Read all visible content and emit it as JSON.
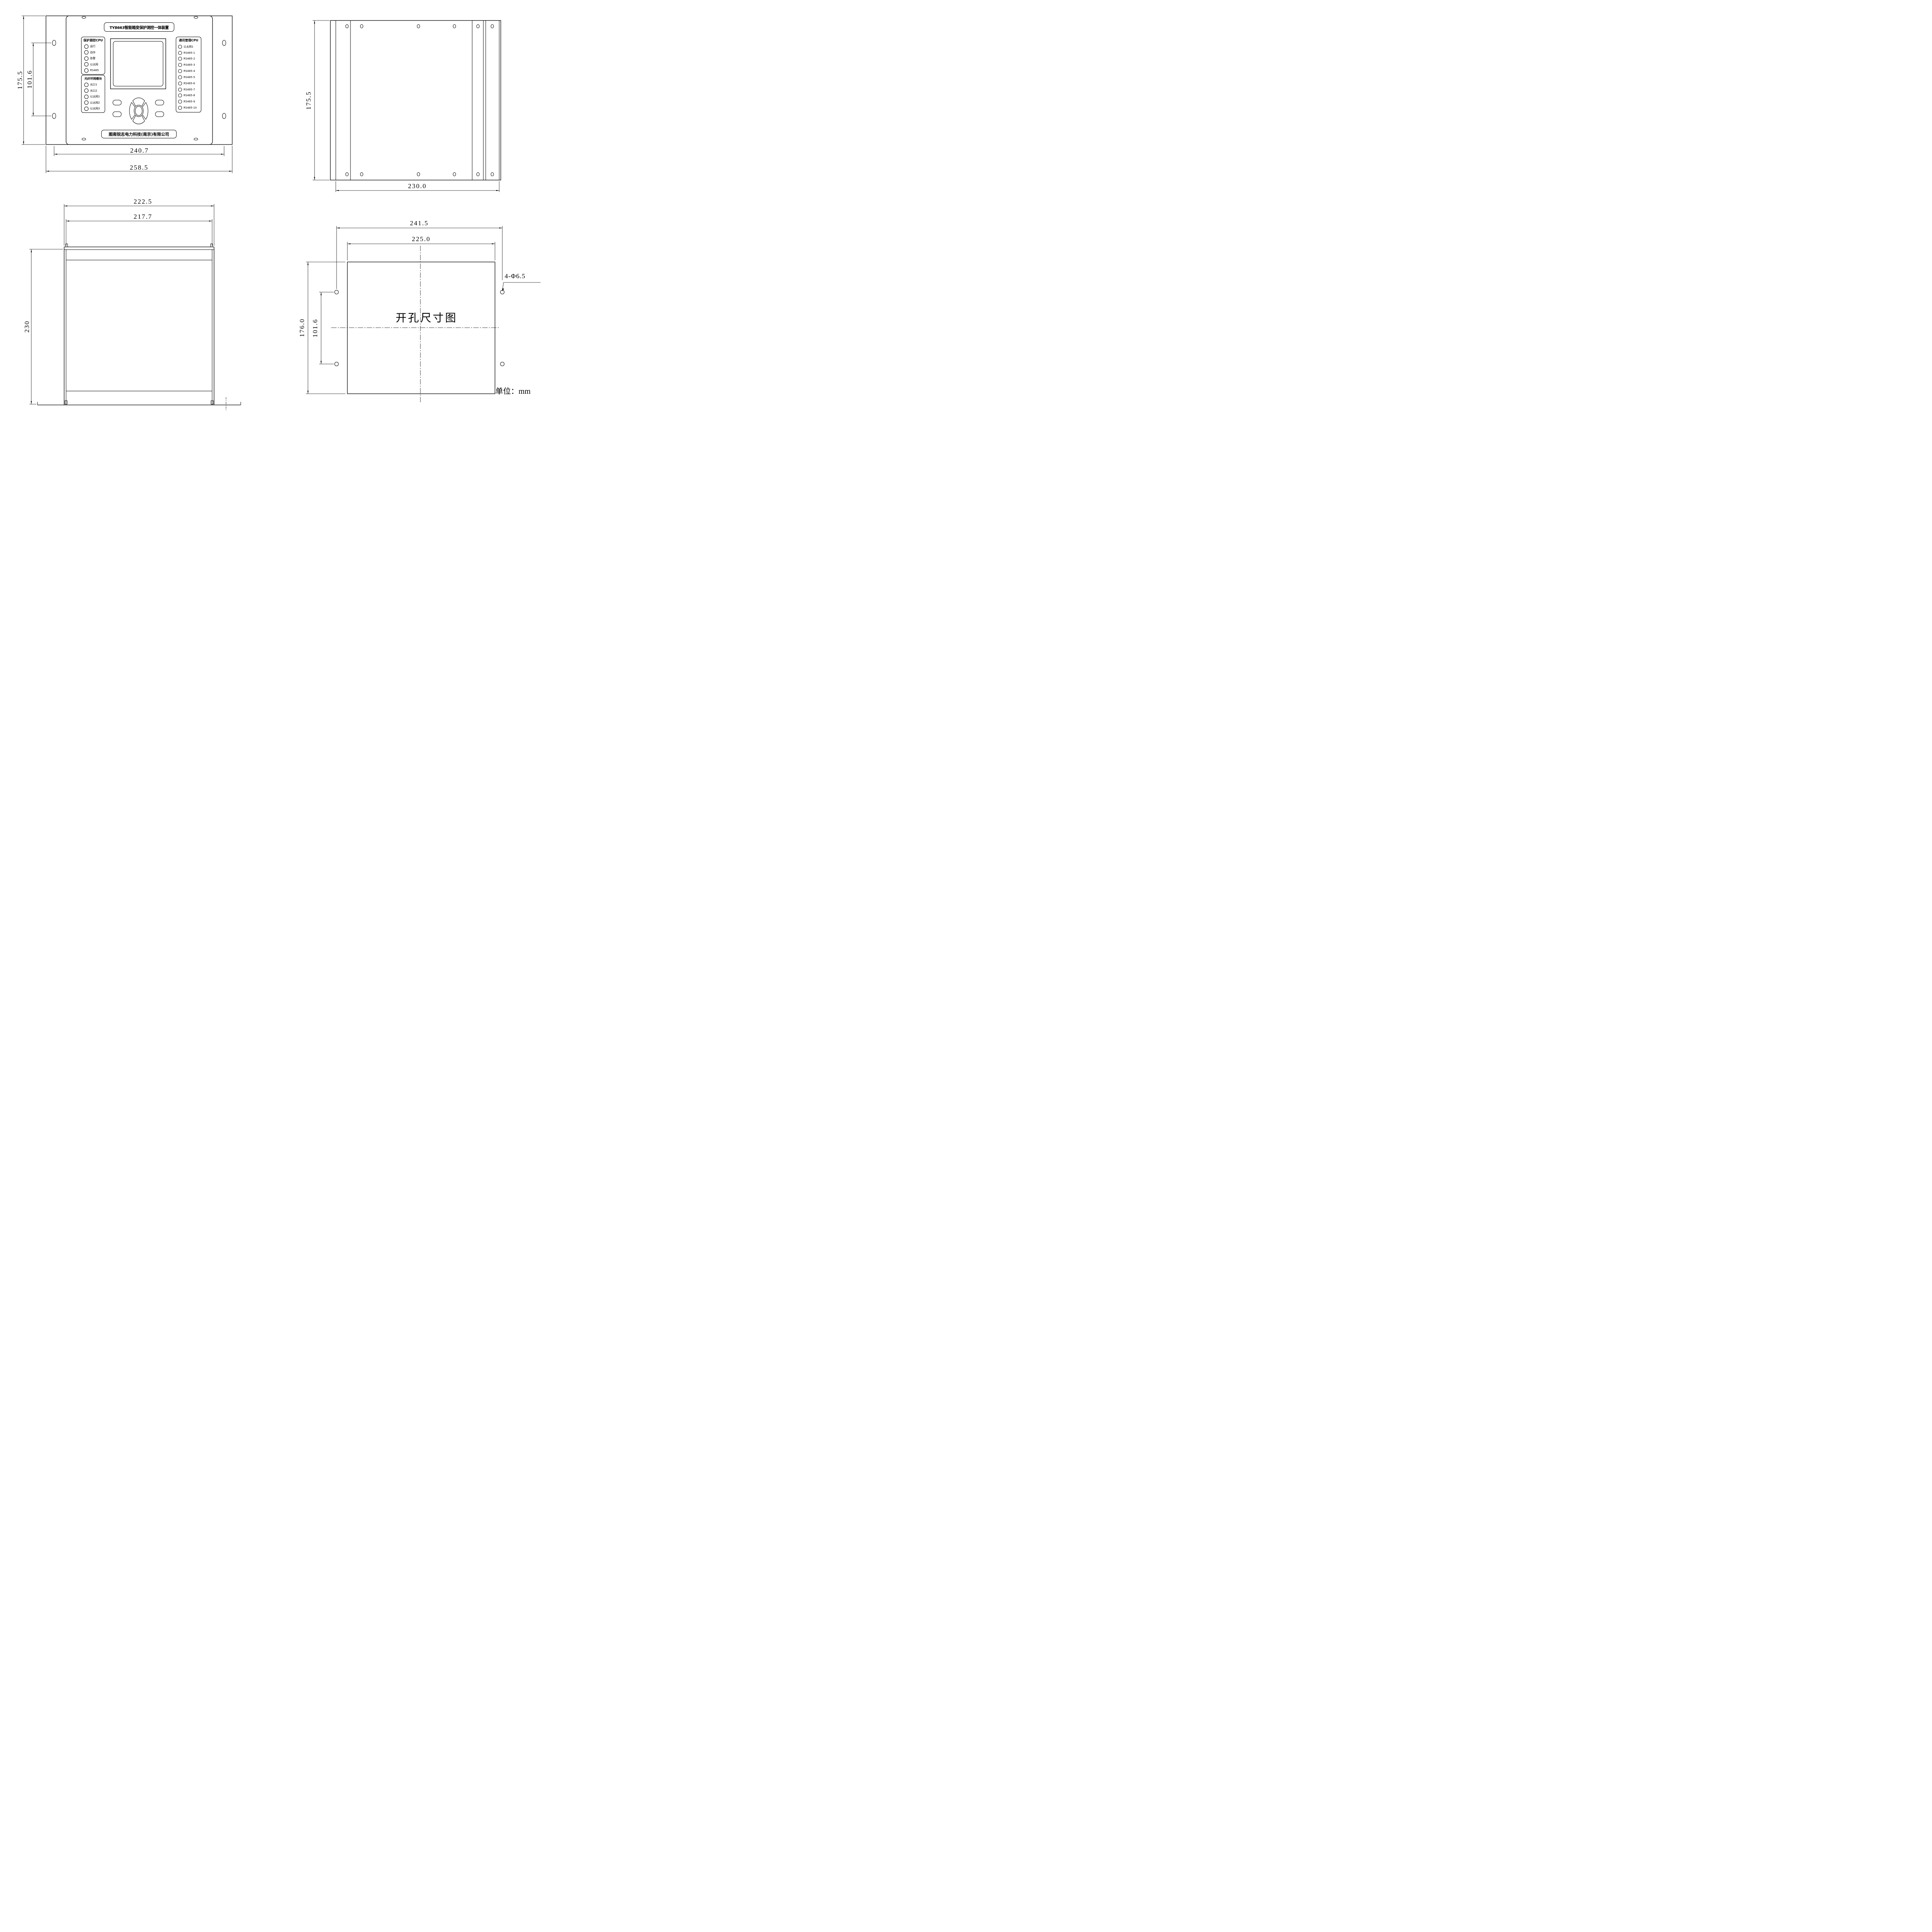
{
  "colors": {
    "ink": "#000000",
    "paper": "#ffffff"
  },
  "unit_note": "单位：mm",
  "front_view": {
    "title": "TY8663智能箱变保护测控一体装置",
    "company": "图南锐志电力科技(南京)有限公司",
    "led_groups": [
      {
        "header": "保护测控CPU",
        "leds": [
          "运行",
          "动作",
          "告警",
          "以太网",
          "RS485"
        ]
      },
      {
        "header": "光纤环网模块",
        "leds": [
          "光口1",
          "光口2",
          "以太网1",
          "以太网2",
          "以太网3"
        ]
      },
      {
        "header": "通讯管理CPU",
        "leds": [
          "以太网1",
          "RS485-1",
          "RS485-2",
          "RS485-3",
          "RS485-4",
          "RS485-5",
          "RS485-6",
          "RS485-7",
          "RS485-8",
          "RS485-9",
          "RS485-10"
        ]
      }
    ],
    "dims": {
      "height": "175.5",
      "hole_spacing_v": "101.6",
      "hole_spacing_h": "240.7",
      "width": "258.5"
    }
  },
  "top_view": {
    "dims": {
      "depth": "175.5",
      "width": "230.0"
    }
  },
  "side_view": {
    "dims": {
      "width_outer": "222.5",
      "width_inner": "217.7",
      "height": "230"
    }
  },
  "cutout_view": {
    "label": "开孔尺寸图",
    "hole_note": "4-Φ6.5",
    "dims": {
      "hole_spacing_h": "241.5",
      "cut_width": "225.0",
      "cut_height": "176.0",
      "hole_spacing_v": "101.6"
    }
  }
}
